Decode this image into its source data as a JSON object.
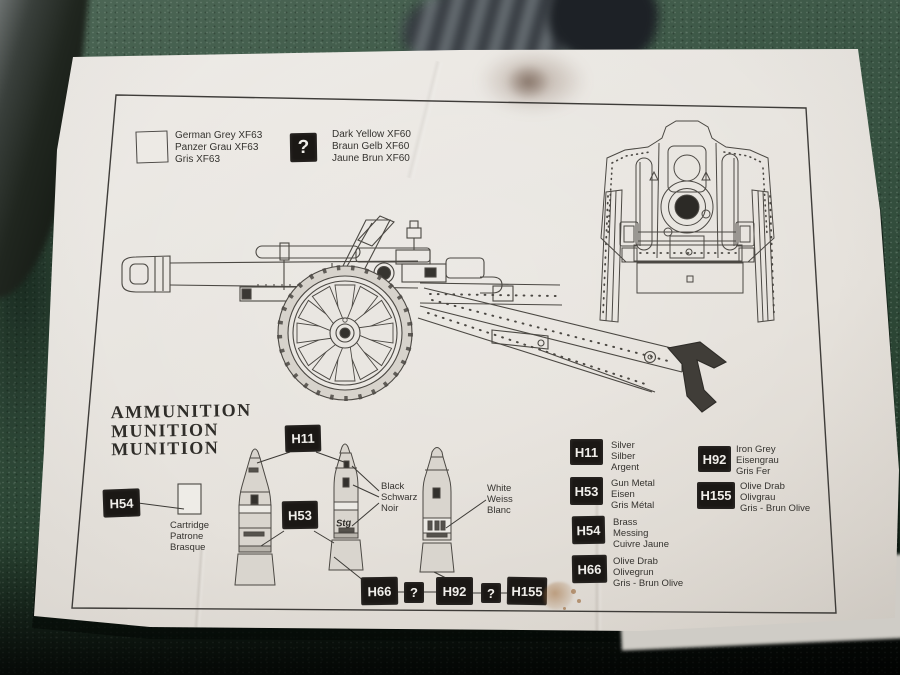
{
  "colors": {
    "table_green": "#324d3c",
    "paper": "#e9e6e1",
    "chip_black": "#1b1815",
    "chip_text": "#f0eeea",
    "print_ink": "#45423d"
  },
  "color_key_top": {
    "grey": {
      "swatch": "outlined-white-square",
      "labels": [
        "German Grey XF63",
        "Panzer Grau XF63",
        "Gris XF63"
      ]
    },
    "dark_yellow": {
      "symbol": "?",
      "labels": [
        "Dark Yellow XF60",
        "Braun Gelb XF60",
        "Jaune Brun XF60"
      ]
    }
  },
  "ammunition": {
    "heading": [
      "AMMUNITION",
      "MUNITION",
      "MUNITION"
    ],
    "cartridge": {
      "chip": "H54",
      "labels": [
        "Cartridge",
        "Patrone",
        "Brasque"
      ]
    },
    "shell_chips": {
      "tip": "H11",
      "body": "H53"
    },
    "black_callout": [
      "Black",
      "Schwarz",
      "Noir"
    ],
    "white_callout": [
      "White",
      "Weiss",
      "Blanc"
    ],
    "shell_marking": "Stg",
    "case_chain": [
      "H66",
      "?",
      "H92",
      "?",
      "H155"
    ]
  },
  "paint_key": [
    {
      "code": "H11",
      "labels": [
        "Silver",
        "Silber",
        "Argent"
      ]
    },
    {
      "code": "H53",
      "labels": [
        "Gun Metal",
        "Eisen",
        "Gris Métal"
      ]
    },
    {
      "code": "H54",
      "labels": [
        "Brass",
        "Messing",
        "Cuivre Jaune"
      ]
    },
    {
      "code": "H66",
      "labels": [
        "Olive Drab",
        "Olivegrun",
        "Gris - Brun Olive"
      ]
    },
    {
      "code": "H92",
      "labels": [
        "Iron Grey",
        "Eisengrau",
        "Gris Fer"
      ]
    },
    {
      "code": "H155",
      "labels": [
        "Olive Drab",
        "Olivgrau",
        "Gris - Brun Olive"
      ]
    }
  ]
}
